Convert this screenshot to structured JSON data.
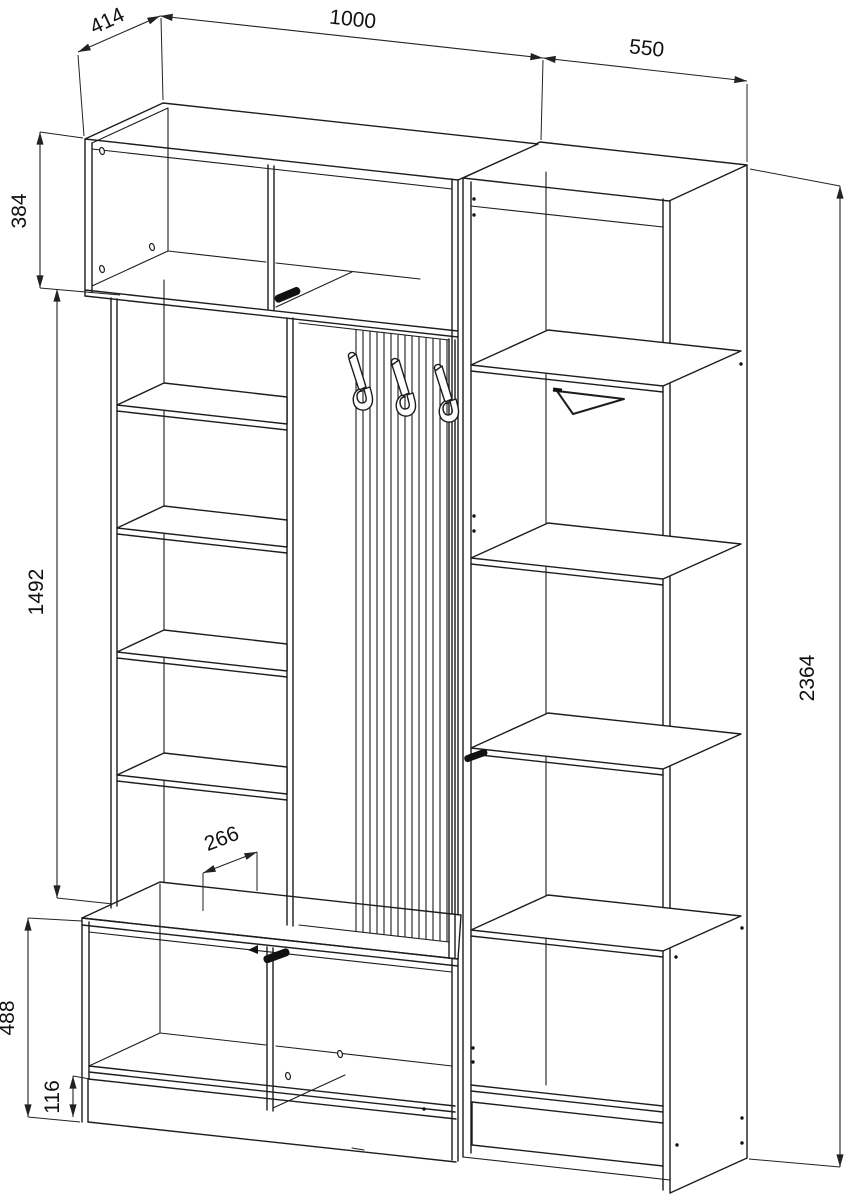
{
  "drawing": {
    "background": "#ffffff",
    "line_color": "#1d1d1d",
    "hardware_color": "#111111"
  },
  "dimensions": {
    "depth": "414",
    "left_section_width": "1000",
    "right_section_width": "550",
    "top_cabinet_height": "384",
    "middle_section_height": "1492",
    "total_height": "2364",
    "hook_panel_depth": "266",
    "bottom_cabinet_height": "488",
    "plinth_height": "116"
  }
}
